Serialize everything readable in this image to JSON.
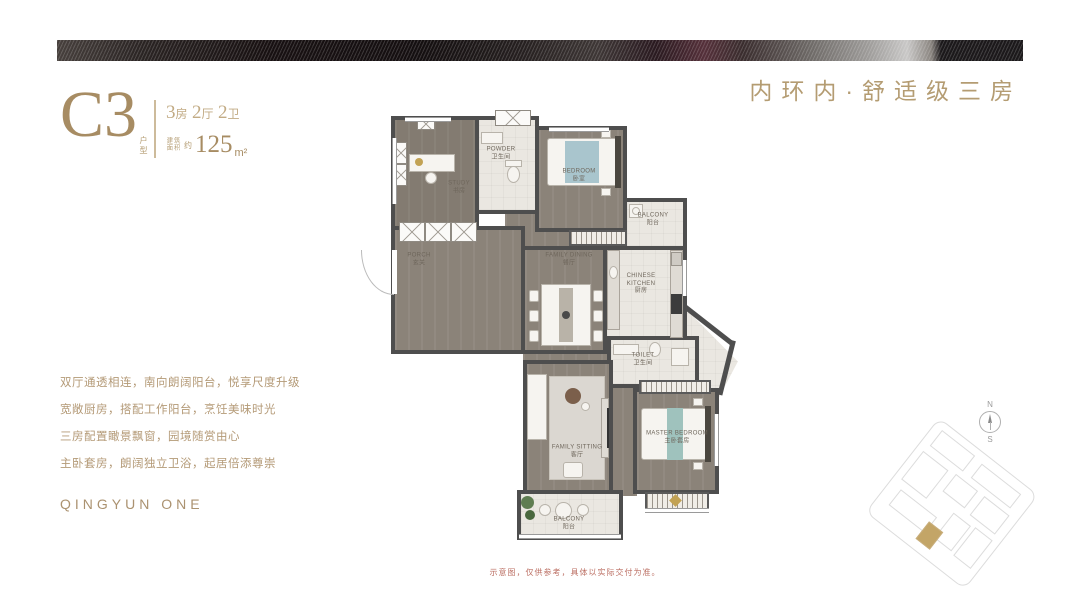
{
  "header": {
    "tagline": "内环内·舒适级三房"
  },
  "unit": {
    "code": "C3",
    "code_suffix": "户型",
    "layout": {
      "n1": "3",
      "u1": "房",
      "n2": "2",
      "u2": "厅",
      "n3": "2",
      "u3": "卫"
    },
    "area_label_1": "建筑",
    "area_label_2": "面积",
    "area_approx": "约",
    "area_value": "125",
    "area_unit": "m²"
  },
  "features": [
    "双厅通透相连，南向朗阔阳台，悦享尺度升级",
    "宽敞厨房，搭配工作阳台，烹饪美味时光",
    "三房配置瞰景飘窗，园境随赏由心",
    "主卧套房，朗阔独立卫浴，起居倍添尊崇"
  ],
  "brand": "QINGYUN ONE",
  "disclaimer": "示意图，仅供参考，具体以实际交付为准。",
  "compass": {
    "north": "N",
    "south": "S"
  },
  "floorplan": {
    "rooms": [
      {
        "id": "study",
        "en": "STUDY",
        "cn": "书房"
      },
      {
        "id": "powder",
        "en": "POWDER",
        "cn": "卫生间"
      },
      {
        "id": "bedroom",
        "en": "BEDROOM",
        "cn": "卧室"
      },
      {
        "id": "work-balcony",
        "en": "BALCONY",
        "cn": "阳台"
      },
      {
        "id": "kitchen",
        "en": "CHINESE KITCHEN",
        "cn": "厨房"
      },
      {
        "id": "dining",
        "en": "FAMILY DINING",
        "cn": "餐厅"
      },
      {
        "id": "porch",
        "en": "PORCH",
        "cn": "玄关"
      },
      {
        "id": "toilet",
        "en": "TOILET",
        "cn": "卫生间"
      },
      {
        "id": "living",
        "en": "FAMILY SITTING",
        "cn": "客厅"
      },
      {
        "id": "master",
        "en": "MASTER BEDROOM",
        "cn": "主卧套房"
      },
      {
        "id": "balcony",
        "en": "BALCONY",
        "cn": "阳台"
      }
    ]
  },
  "colors": {
    "accent_gold": "#b49c72",
    "code_gold": "#a78c63",
    "feature_text": "#b49a77",
    "disclaimer_red": "#bb6e62",
    "wall": "#4e4e4e",
    "wood_floor": "#8b8379",
    "tile_floor": "#eae7e1",
    "bed_blue": "#a9c5cd",
    "bed_teal": "#9fc2bd"
  }
}
